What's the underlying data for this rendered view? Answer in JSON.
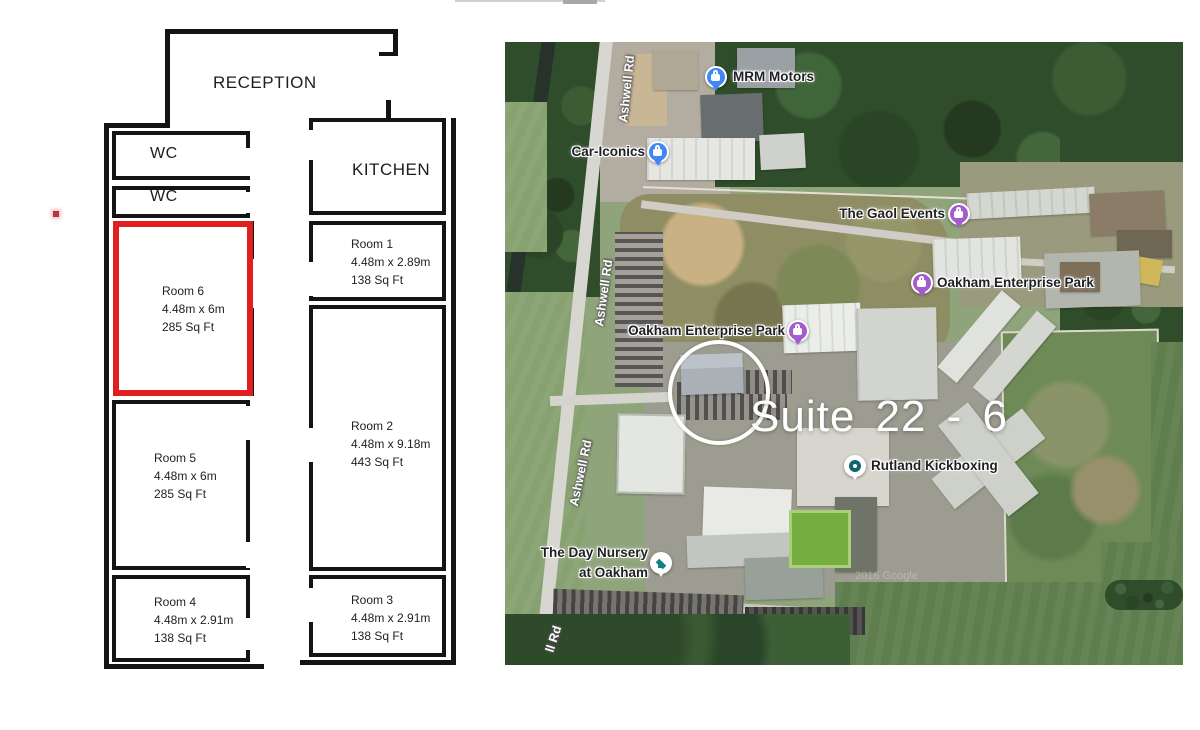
{
  "floor_plan": {
    "reception_label": "RECEPTION",
    "kitchen_label": "KITCHEN",
    "wc_labels": [
      "WC",
      "WC"
    ],
    "highlight_color": "#e01f1f",
    "rooms": [
      {
        "name": "Room 6",
        "dimensions": "4.48m x 6m",
        "area": "285 Sq Ft",
        "highlighted": true
      },
      {
        "name": "Room 5",
        "dimensions": "4.48m x 6m",
        "area": "285 Sq Ft",
        "highlighted": false
      },
      {
        "name": "Room 4",
        "dimensions": "4.48m x 2.91m",
        "area": "138 Sq Ft",
        "highlighted": false
      },
      {
        "name": "Room 1",
        "dimensions": "4.48m x 2.89m",
        "area": "138 Sq Ft",
        "highlighted": false
      },
      {
        "name": "Room 2",
        "dimensions": "4.48m x 9.18m",
        "area": "443 Sq Ft",
        "highlighted": false
      },
      {
        "name": "Room 3",
        "dimensions": "4.48m x 2.91m",
        "area": "138 Sq Ft",
        "highlighted": false
      }
    ]
  },
  "map": {
    "suite_label": "Suite 22 - 6",
    "suite_text_color": "#ffffff",
    "watermark": "2016 Google",
    "road_labels": [
      "Ashwell Rd",
      "Ashwell Rd",
      "Ashwell Rd",
      "ll Rd"
    ],
    "pin_colors": {
      "shop_blue": "#3f87f5",
      "event_purple": "#a55ad0",
      "plain_white": "#ffffff",
      "teal": "#116470"
    },
    "pois": [
      {
        "label": "MRM Motors",
        "icon": "shopping-bag",
        "pin_color": "#3f87f5"
      },
      {
        "label": "Car-Iconics",
        "icon": "shopping-bag",
        "pin_color": "#3f87f5"
      },
      {
        "label": "The Gaol Events",
        "icon": "shopping-bag",
        "pin_color": "#a55ad0"
      },
      {
        "label": "Oakham Enterprise Park",
        "icon": "shopping-bag",
        "pin_color": "#a55ad0"
      },
      {
        "label": "Oakham Enterprise Park",
        "icon": "shopping-bag",
        "pin_color": "#a55ad0"
      },
      {
        "label": "Rutland Kickboxing",
        "icon": "place-dot",
        "pin_color": "#ffffff"
      },
      {
        "label_line1": "The Day Nursery",
        "label_line2": "at Oakham",
        "icon": "graduation-cap",
        "pin_color": "#ffffff"
      }
    ]
  }
}
